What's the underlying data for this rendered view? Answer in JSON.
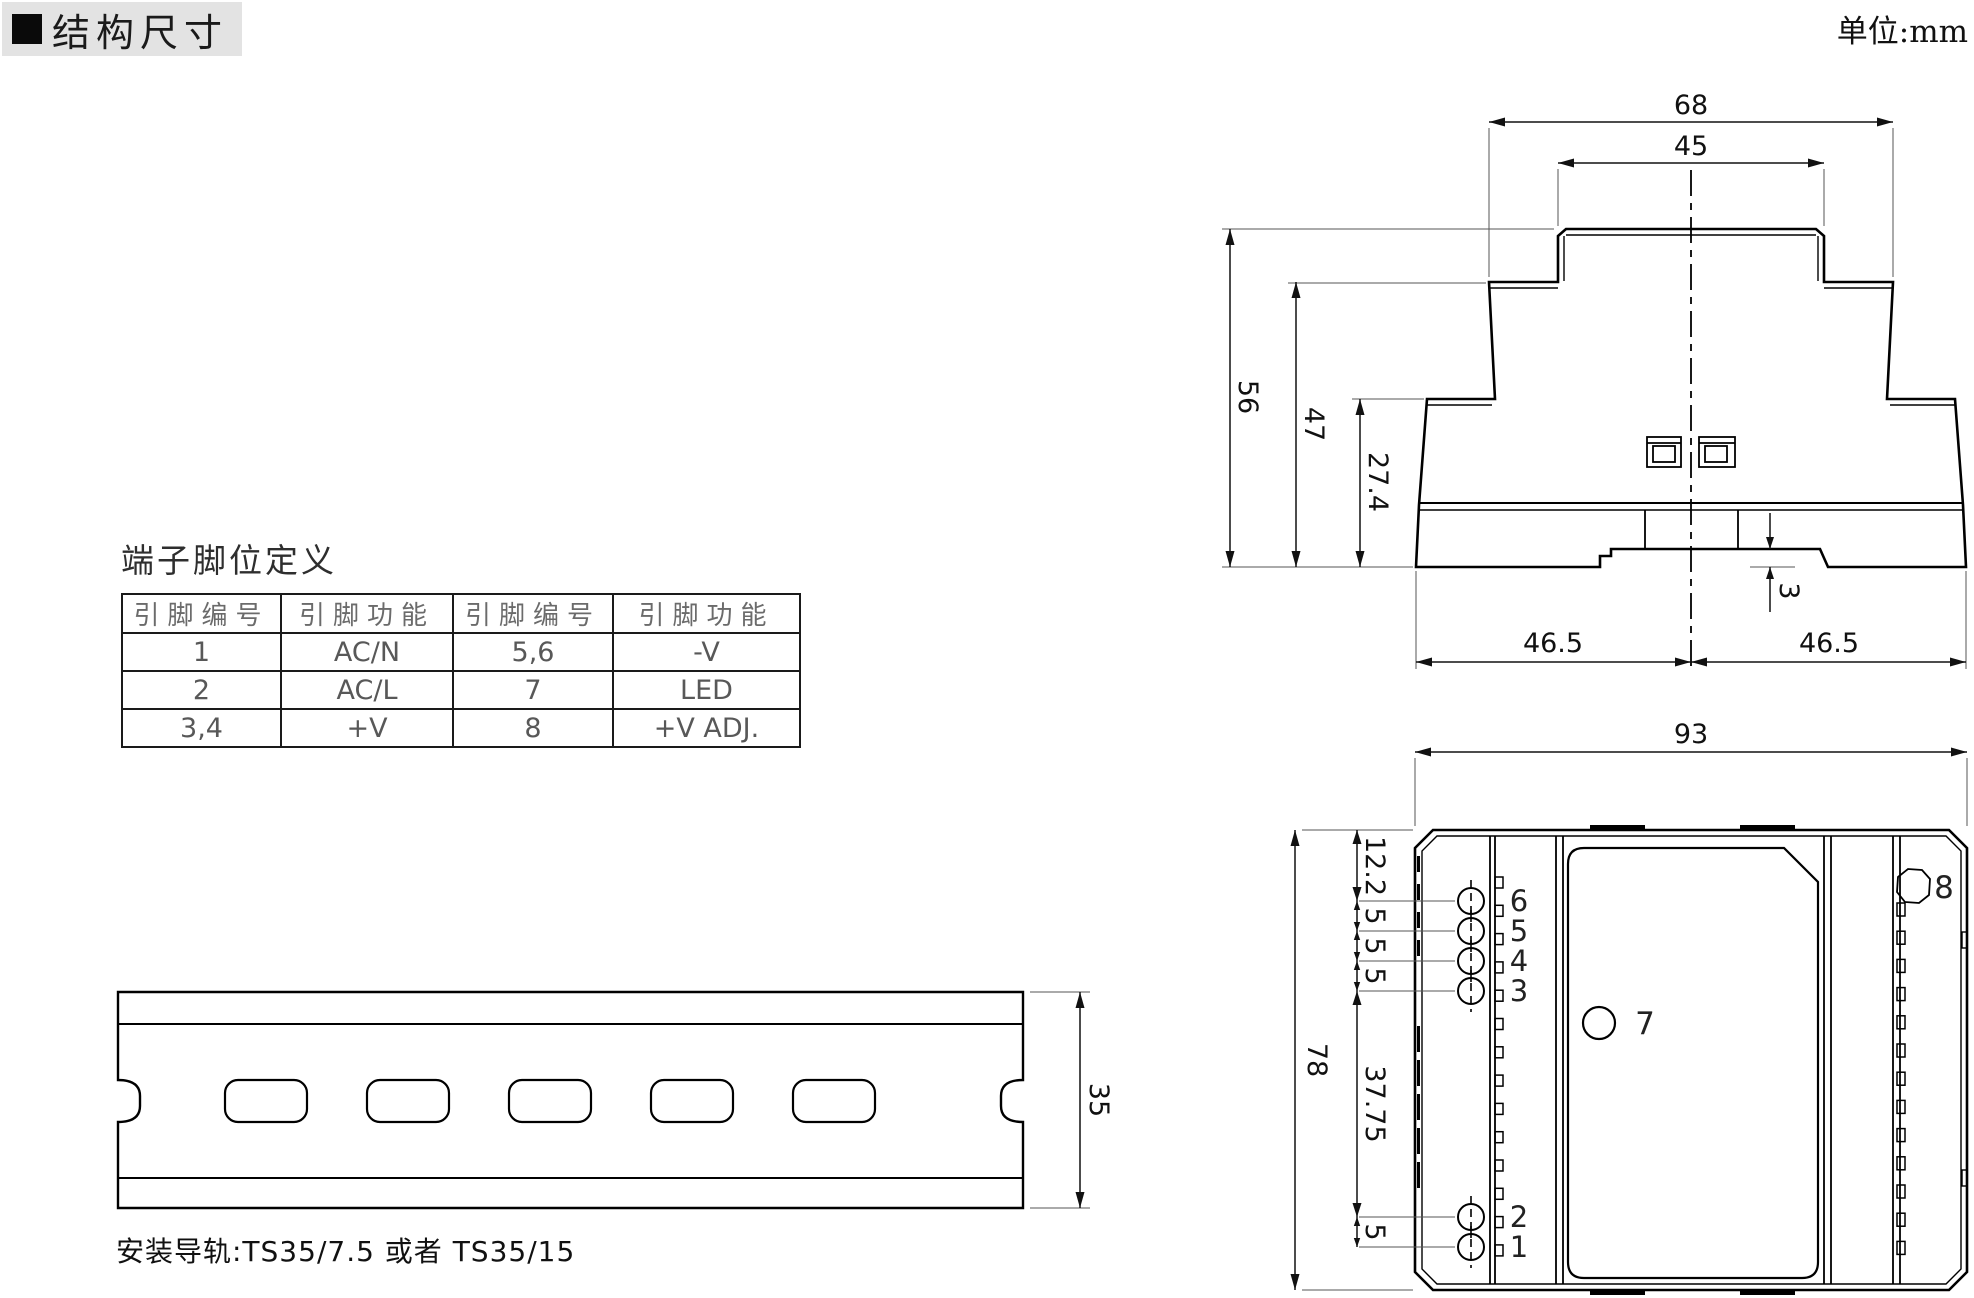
{
  "header": {
    "title": "结构尺寸",
    "units_label": "单位:mm"
  },
  "pin_table": {
    "title": "端子脚位定义",
    "columns": [
      "引脚编号",
      "引脚功能",
      "引脚编号",
      "引脚功能"
    ],
    "rows": [
      [
        "1",
        "AC/N",
        "5,6",
        "-V"
      ],
      [
        "2",
        "AC/L",
        "7",
        "LED"
      ],
      [
        "3,4",
        "+V",
        "8",
        "+V ADJ."
      ]
    ]
  },
  "side_view": {
    "dim_upper_width": "68",
    "dim_top_width": "45",
    "dim_height_total": "56",
    "dim_height_mid": "47",
    "dim_height_lower": "27.4",
    "dim_recess_depth": "3",
    "dim_base_left_half": "46.5",
    "dim_base_right_half": "46.5"
  },
  "front_view": {
    "dim_width": "93",
    "dim_height": "78",
    "dim_chain": [
      "12.2",
      "5",
      "5",
      "5",
      "37.75",
      "5"
    ],
    "pin_labels_top": [
      "6",
      "5",
      "4",
      "3"
    ],
    "pin_labels_bottom": [
      "2",
      "1"
    ],
    "led_label": "7",
    "pot_label": "8"
  },
  "rail_view": {
    "dim_height": "35",
    "note": "安装导轨:TS35/7.5 或者 TS35/15"
  },
  "colors": {
    "line": "#000000",
    "text": "#111111",
    "header_bg": "#e3e3e3"
  }
}
